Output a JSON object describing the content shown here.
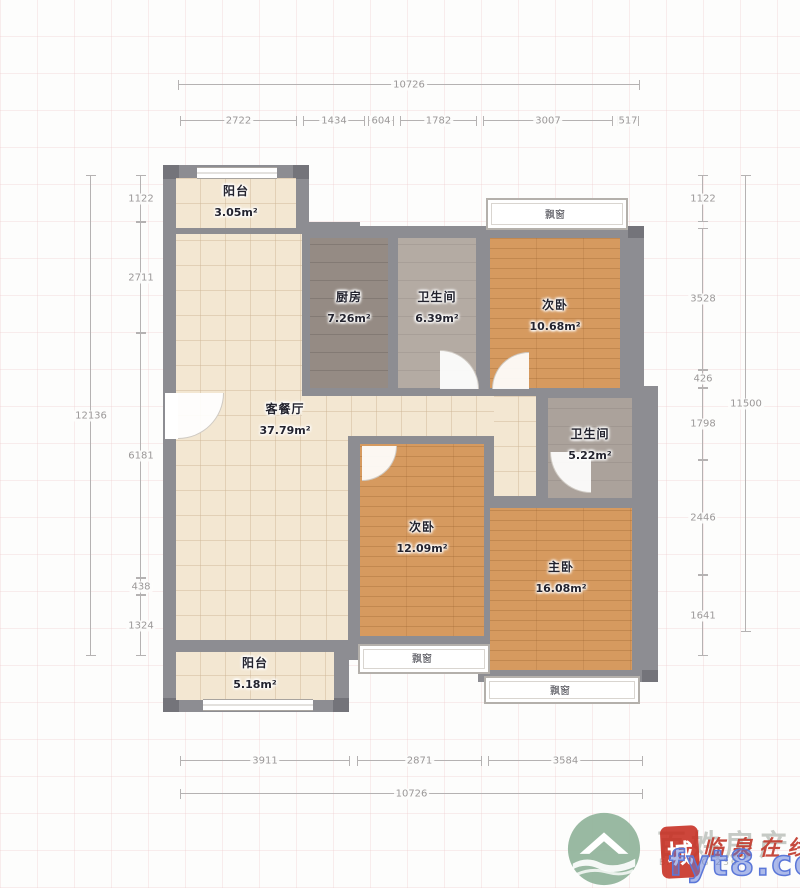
{
  "rooms": [
    {
      "id": "balcony-top",
      "name": "阳台",
      "area": "3.05m²"
    },
    {
      "id": "kitchen",
      "name": "厨房",
      "area": "7.26m²"
    },
    {
      "id": "bath-1",
      "name": "卫生间",
      "area": "6.39m²"
    },
    {
      "id": "bedroom-top",
      "name": "次卧",
      "area": "10.68m²"
    },
    {
      "id": "living-dining",
      "name": "客餐厅",
      "area": "37.79m²"
    },
    {
      "id": "bath-2",
      "name": "卫生间",
      "area": "5.22m²"
    },
    {
      "id": "bedroom-mid",
      "name": "次卧",
      "area": "12.09m²"
    },
    {
      "id": "master-bedroom",
      "name": "主卧",
      "area": "16.08m²"
    },
    {
      "id": "balcony-bottom",
      "name": "阳台",
      "area": "5.18m²"
    }
  ],
  "bay_windows": [
    {
      "label": "飘窗"
    },
    {
      "label": "飘窗"
    },
    {
      "label": "飘窗"
    }
  ],
  "dims": {
    "top": {
      "total": "10726",
      "segments": [
        "2722",
        "1434",
        "604",
        "1782",
        "3007",
        "517"
      ]
    },
    "bottom": {
      "total": "10726",
      "segments": [
        "3911",
        "2871",
        "3584"
      ]
    },
    "left": {
      "total": "12136",
      "segments": [
        "1122",
        "2711",
        "6181",
        "438",
        "1324"
      ]
    },
    "right": {
      "total": "11500",
      "segments": [
        "1122",
        "3528",
        "426",
        "1798",
        "2446",
        "1641"
      ]
    }
  },
  "watermark": {
    "brand": "百姓房产",
    "brand_sub": "BAIXING 236",
    "seal_char": "城",
    "seal_script": "临泉在线",
    "url": "fyt8.com"
  },
  "colors": {
    "wall": "#8d8d92",
    "tile": "#f3e7d2",
    "wood": "#d69a5f",
    "kitchen": "#958b84",
    "bath": "#b4aba3",
    "dimension": "#b5b2b2",
    "seal_red": "#c62c20",
    "url_blue": "#5b77d8",
    "logo_green": "#93b59d"
  }
}
